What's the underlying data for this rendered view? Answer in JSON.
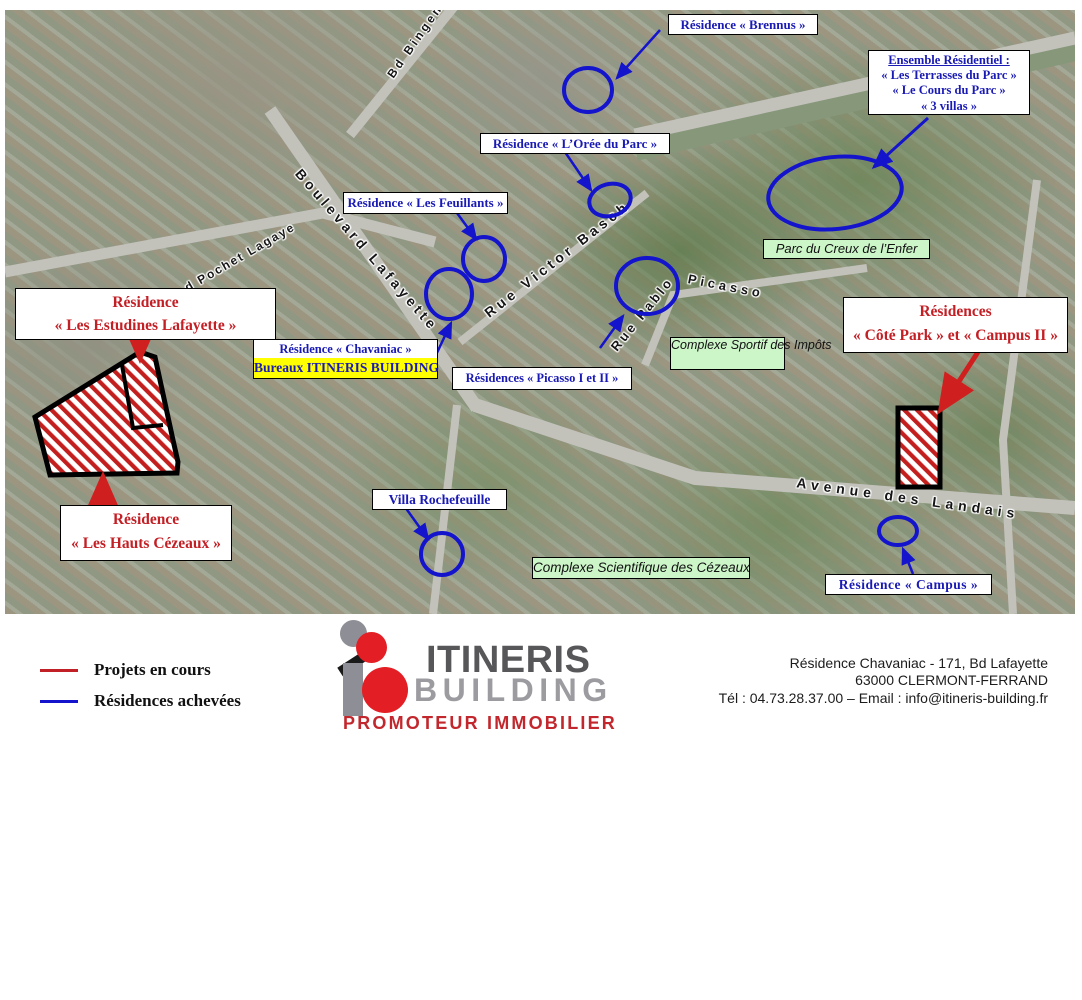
{
  "map": {
    "streets": {
      "bingen": "Bd Bingen",
      "lafayette": "Boulevard Lafayette",
      "victor_basch": "Rue Victor Basch",
      "rue_pablo": "Rue Pablo",
      "picasso": "Picasso",
      "landais": "Avenue des Landais",
      "pochet_lagaye": "d Pochet Lagaye"
    },
    "annotations": {
      "brennus": "Résidence « Brennus »",
      "ensemble_title": "Ensemble Résidentiel :",
      "ensemble_line1": "« Les Terrasses du Parc »",
      "ensemble_line2": "« Le Cours du Parc »",
      "ensemble_line3": "« 3 villas »",
      "oree": "Résidence « L’Orée du Parc »",
      "feuillants": "Résidence « Les Feuillants »",
      "parc_creux": "Parc du Creux de l’Enfer",
      "estudines_line1": "Résidence",
      "estudines_line2": "« Les Estudines Lafayette »",
      "chavaniac": "Résidence « Chavaniac »",
      "bureaux": "Bureaux ITINERIS BUILDING",
      "picasso_residences": "Résidences «  Picasso I et  II »",
      "sportif_line1": "Complexe Sportif",
      "sportif_line2": "des Impôts",
      "cote_park_line1": "Résidences",
      "cote_park_line2": "« Côté Park » et « Campus II »",
      "hauts_line1": "Résidence",
      "hauts_line2": "« Les Hauts Cézeaux »",
      "villa": "Villa Rochefeuille",
      "scientifique": "Complexe Scientifique des Cézeaux",
      "campus": "Résidence « Campus »"
    }
  },
  "legend": {
    "projets": "Projets en cours",
    "achevees": "Résidences achevées"
  },
  "logo": {
    "name_top": "ITINERIS",
    "name_bottom": "BUILDING",
    "tagline": "PROMOTEUR IMMOBILIER"
  },
  "contact": {
    "line1": "Résidence Chavaniac - 171, Bd Lafayette",
    "line2": "63000 CLERMONT-FERRAND",
    "line3": "Tél : 04.73.28.37.00 – Email : info@itineris-building.fr"
  },
  "colors": {
    "annotation_blue": "#1414cc",
    "label_text_blue": "#1a1ab5",
    "project_red": "#cc1f1f",
    "green_label_bg": "#ccf5c8",
    "highlight_yellow": "#ffff00"
  }
}
